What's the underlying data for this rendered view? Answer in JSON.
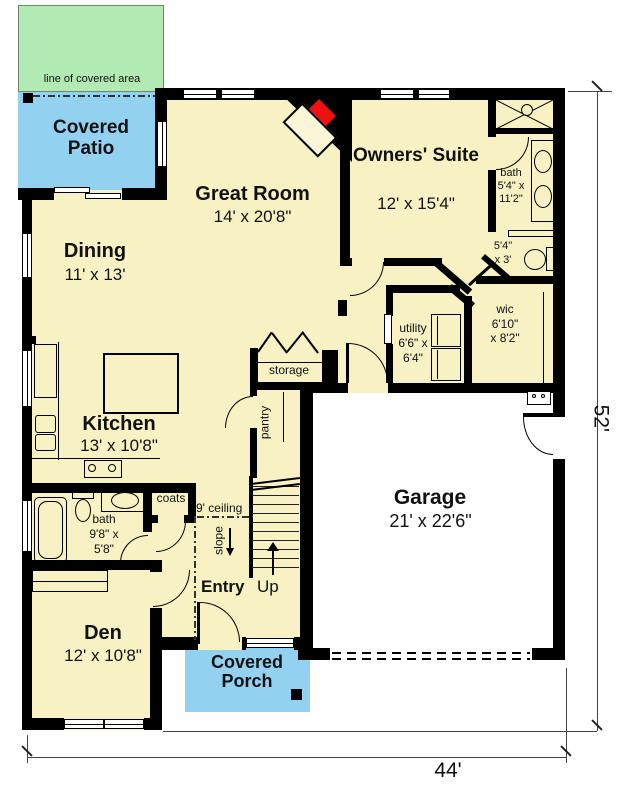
{
  "colors": {
    "room_fill": "#f8f1c3",
    "patio_blue": "#93d1f1",
    "open_area_green": "#b2eab4",
    "fireplace_red": "#ee1111",
    "wall": "#000000",
    "garage_fill": "#ffffff"
  },
  "outdoor": {
    "covered_area_note": "line of covered area",
    "covered_patio": "Covered Patio",
    "covered_porch": "Covered Porch"
  },
  "rooms": {
    "great_room": {
      "name": "Great Room",
      "dims": "14' x 20'8\""
    },
    "owners_suite": {
      "name": "Owners' Suite",
      "dims": "12' x 15'4\""
    },
    "dining": {
      "name": "Dining",
      "dims": "11' x 13'"
    },
    "kitchen": {
      "name": "Kitchen",
      "dims": "13' x 10'8\""
    },
    "garage": {
      "name": "Garage",
      "dims": "21' x 22'6\""
    },
    "den": {
      "name": "Den",
      "dims": "12' x 10'8\""
    },
    "entry": {
      "name": "Entry",
      "up_label": "Up"
    },
    "owners_bath": {
      "name": "bath",
      "dims_l1": "5'4\" x",
      "dims_l2": "11'2\""
    },
    "toilet_room": {
      "dims_l1": "5'4\"",
      "dims_l2": "x 3'"
    },
    "wic": {
      "name": "wic",
      "dims_l1": "6'10\"",
      "dims_l2": "x 8'2\""
    },
    "utility": {
      "name": "utility",
      "dims_l1": "6'6\" x",
      "dims_l2": "6'4\""
    },
    "main_bath": {
      "name": "bath",
      "dims_l1": "9'8\" x",
      "dims_l2": "5'8\""
    },
    "storage": {
      "name": "storage"
    },
    "pantry": {
      "name": "pantry"
    },
    "coats": {
      "name": "coats"
    }
  },
  "annotations": {
    "ceiling_height": "9' ceiling",
    "slope": "slope"
  },
  "overall_dimensions": {
    "width": "44'",
    "depth": "52'"
  }
}
